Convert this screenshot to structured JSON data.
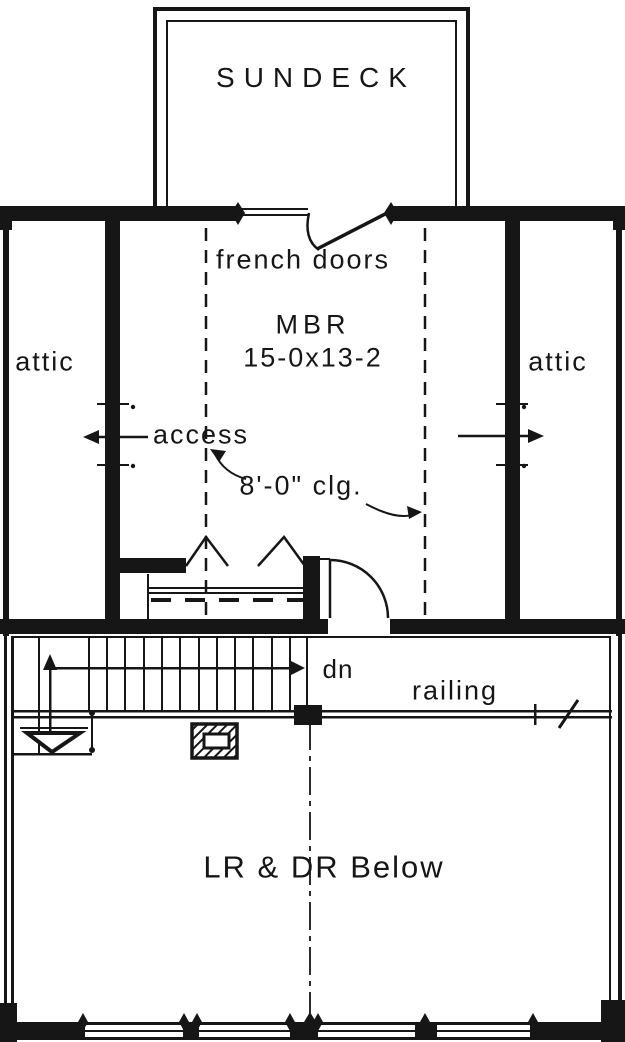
{
  "plan": {
    "title": "Upper floor plan",
    "labels": {
      "sundeck": "SUNDECK",
      "french_doors": "french doors",
      "master_bedroom": "MBR",
      "master_bedroom_dim": "15-0x13-2",
      "attic_left": "attic",
      "attic_right": "attic",
      "access": "access",
      "ceiling_height": "8'-0\" clg.",
      "stairs_down": "dn",
      "railing": "railing",
      "open_below": "LR & DR Below"
    },
    "colors": {
      "ink": "#161616",
      "paper": "#ffffff"
    }
  }
}
